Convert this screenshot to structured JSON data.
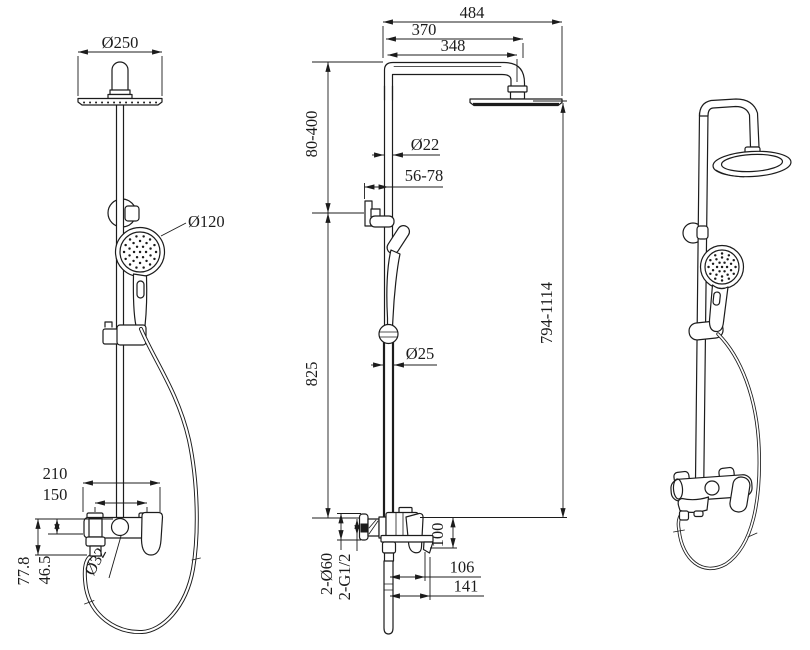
{
  "colors": {
    "line": "#1c1c1c",
    "background": "#ffffff"
  },
  "views": {
    "front": {
      "dims": {
        "rain_head_diameter": "Ø250",
        "hand_shower_diameter": "Ø120",
        "valve_overall_width": "210",
        "inlet_center_spacing": "150",
        "outlet_drop": "77.8",
        "spout_drop": "46.5",
        "diverter_diameter": "Ø32"
      }
    },
    "side": {
      "dims": {
        "overall_reach": "484",
        "arm_reach": "370",
        "head_center_reach": "348",
        "head_to_bracket_range": "80-400",
        "upper_pipe_diameter": "Ø22",
        "wall_to_pipe_range": "56-78",
        "bracket_to_valve": "825",
        "lower_pipe_diameter": "Ø25",
        "overall_height_range": "794-1114",
        "escutcheons": "2-Ø60",
        "inlet_threads": "2-G1/2",
        "valve_height": "100",
        "spout_reach": "106",
        "handle_reach": "141"
      }
    }
  }
}
